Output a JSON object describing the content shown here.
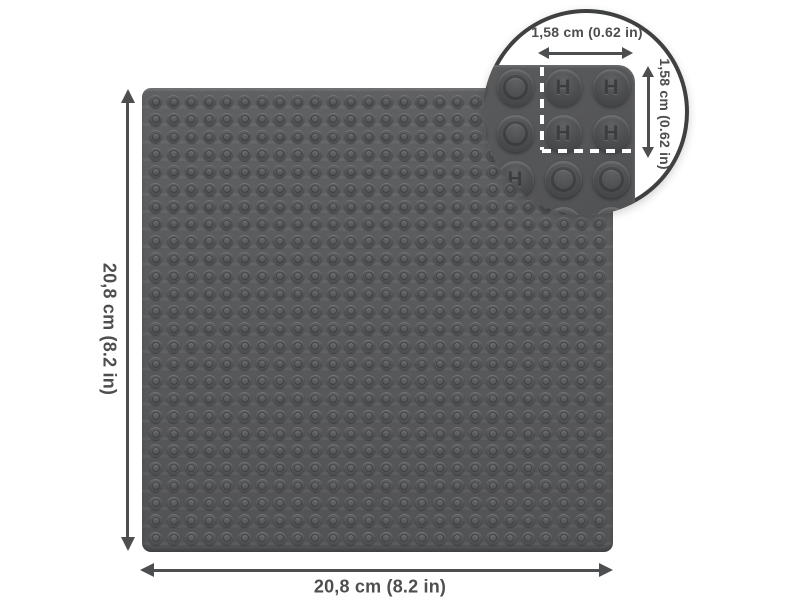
{
  "diagram": {
    "title_hint": "baseplate dimension diagram",
    "height_label": "20,8 cm (8.2 in)",
    "width_label": "20,8 cm (8.2 in)",
    "plate": {
      "stud_rows": 26,
      "stud_cols": 26
    },
    "inset": {
      "width_label": "1,58 cm (0.62 in)",
      "height_label": "1,58 cm (0.62 in)",
      "logo_letter": "H",
      "stud_pattern": [
        [
          "plain",
          "plain",
          "logo",
          "logo"
        ],
        [
          "plain",
          "plain",
          "logo",
          "logo"
        ],
        [
          "logo",
          "logo",
          "plain",
          "plain"
        ],
        [
          "plain",
          "plain",
          "logo",
          "logo"
        ]
      ]
    },
    "colors": {
      "background": "#ffffff",
      "plate": "#57585a",
      "annotation": "#4d4e50",
      "inset_border": "#3f4042",
      "dash": "#ffffff"
    }
  }
}
